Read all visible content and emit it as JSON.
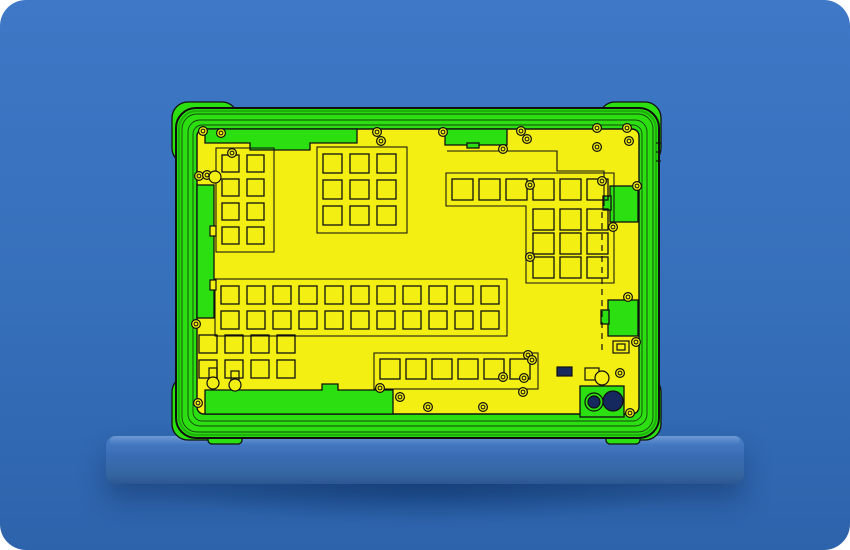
{
  "scene": {
    "alt": "CAD-style cutaway render of a rugged tablet rear shell, shown in bright green and yellow with black outlines, standing on a blue wall shelf against a blue background",
    "palette": {
      "bg_top": "#3e78c6",
      "bg_mid": "#366fba",
      "bg_bottom": "#2d63ab",
      "under_shadow": "#1d4f91",
      "shelf_top": "#4e82ca",
      "shelf_face": "#3a6db6",
      "shelf_edge": "#2b5691",
      "device_green": "#2bdf10",
      "device_green_dark": "#159907",
      "panel_yellow": "#f4ef13",
      "outline": "#101010",
      "lens_navy": "#16295e"
    },
    "device": {
      "grids": [
        {
          "name": "grid-top-left",
          "x": 222,
          "y": 155,
          "cols": 2,
          "rows": 4,
          "cell": 17,
          "px": 25,
          "py": 24
        },
        {
          "name": "grid-top-mid",
          "x": 323,
          "y": 154,
          "cols": 3,
          "rows": 3,
          "cell": 19,
          "px": 27,
          "py": 26
        },
        {
          "name": "row-top-right",
          "x": 452,
          "y": 179,
          "cols": 6,
          "rows": 1,
          "cell": 21,
          "px": 27,
          "py": 27
        },
        {
          "name": "grid-right",
          "x": 533,
          "y": 209,
          "cols": 3,
          "rows": 3,
          "cell": 21,
          "px": 27,
          "py": 24
        },
        {
          "name": "band-middle",
          "x": 221,
          "y": 286,
          "cols": 11,
          "rows": 2,
          "cell": 18,
          "px": 26,
          "py": 25
        },
        {
          "name": "grid-bottom-left",
          "x": 199,
          "y": 335,
          "cols": 4,
          "rows": 2,
          "cell": 18,
          "px": 26,
          "py": 25
        },
        {
          "name": "row-bottom-mid",
          "x": 380,
          "y": 359,
          "cols": 6,
          "rows": 1,
          "cell": 20,
          "px": 26,
          "py": 26
        }
      ],
      "containers": [
        {
          "t": "rect",
          "x": 216,
          "y": 148,
          "w": 58,
          "h": 104
        },
        {
          "t": "rect",
          "x": 317,
          "y": 147,
          "w": 90,
          "h": 86
        },
        {
          "t": "path",
          "d": "M446,173 H614 V283 H526 V206 H446 Z"
        },
        {
          "t": "rect",
          "x": 215,
          "y": 279,
          "w": 292,
          "h": 57
        },
        {
          "t": "rect",
          "x": 374,
          "y": 353,
          "w": 164,
          "h": 36
        }
      ],
      "green_shapes": [
        {
          "t": "rect",
          "x": 197,
          "y": 185,
          "w": 17,
          "h": 133,
          "name": "left-rail"
        },
        {
          "t": "path",
          "d": "M205,129 H357 V143 H310 V150 H250 V143 H205 Z",
          "name": "top-tab-left"
        },
        {
          "t": "rect",
          "x": 445,
          "y": 129,
          "w": 62,
          "h": 16,
          "name": "top-tab-right"
        },
        {
          "t": "rect",
          "x": 467,
          "y": 143,
          "w": 12,
          "h": 5,
          "name": "top-tab-right-notch"
        },
        {
          "t": "path",
          "d": "M205,390 H322 V384 H338 V390 H393 V414 H205 Z",
          "name": "bottom-bracket"
        },
        {
          "t": "rect",
          "x": 610,
          "y": 186,
          "w": 28,
          "h": 36,
          "name": "right-port-upper"
        },
        {
          "t": "rect",
          "x": 603,
          "y": 196,
          "w": 8,
          "h": 14,
          "name": "right-port-upper-step"
        },
        {
          "t": "rect",
          "x": 608,
          "y": 300,
          "w": 30,
          "h": 36,
          "name": "right-port-lower"
        },
        {
          "t": "rect",
          "x": 601,
          "y": 310,
          "w": 8,
          "h": 14,
          "name": "right-port-lower-step"
        },
        {
          "t": "rect",
          "x": 580,
          "y": 386,
          "w": 44,
          "h": 31,
          "name": "camera-module"
        }
      ],
      "details": [
        {
          "t": "rect",
          "x": 557,
          "y": 367,
          "w": 15,
          "h": 9,
          "fill": "navy",
          "name": "connector-chip"
        },
        {
          "t": "rect",
          "x": 613,
          "y": 341,
          "w": 16,
          "h": 12,
          "fill": "none",
          "name": "port-outline"
        },
        {
          "t": "rect",
          "x": 617,
          "y": 344,
          "w": 8,
          "h": 6,
          "fill": "none",
          "name": "port-pin"
        },
        {
          "t": "rect",
          "x": 585,
          "y": 368,
          "w": 14,
          "h": 12,
          "fill": "none",
          "name": "bracket-outline"
        },
        {
          "t": "circle",
          "cx": 594,
          "cy": 402,
          "r": 9,
          "fill": "green",
          "name": "camera-lens-left-ring"
        },
        {
          "t": "circle",
          "cx": 594,
          "cy": 402,
          "r": 6,
          "fill": "navy",
          "name": "camera-lens-left"
        },
        {
          "t": "circle",
          "cx": 613,
          "cy": 401,
          "r": 10,
          "fill": "navy",
          "name": "camera-lens-right"
        },
        {
          "t": "circle",
          "cx": 602,
          "cy": 378,
          "r": 7,
          "fill": "yellow",
          "name": "flash-ring"
        },
        {
          "t": "path",
          "d": "M447,151 H557 V171 H604 V206",
          "fill": "none",
          "name": "trace-line"
        },
        {
          "t": "line",
          "x1": 602,
          "y1": 212,
          "x2": 602,
          "y2": 352,
          "dash": "6 5",
          "name": "fold-line"
        },
        {
          "t": "line",
          "x1": 656,
          "y1": 143,
          "x2": 661,
          "y2": 143,
          "name": "edge-nub"
        },
        {
          "t": "line",
          "x1": 656,
          "y1": 152,
          "x2": 661,
          "y2": 152,
          "name": "edge-nub"
        },
        {
          "t": "line",
          "x1": 656,
          "y1": 161,
          "x2": 661,
          "y2": 161,
          "name": "edge-nub"
        },
        {
          "t": "rect",
          "x": 209,
          "y": 368,
          "w": 8,
          "h": 10,
          "fill": "none",
          "name": "mic-bracket"
        },
        {
          "t": "circle",
          "cx": 213,
          "cy": 383,
          "r": 6,
          "fill": "yellow",
          "name": "mic-hole"
        },
        {
          "t": "rect",
          "x": 231,
          "y": 371,
          "w": 8,
          "h": 10,
          "fill": "none",
          "name": "mic-bracket"
        },
        {
          "t": "circle",
          "cx": 235,
          "cy": 385,
          "r": 6,
          "fill": "yellow",
          "name": "mic-hole"
        },
        {
          "t": "rect",
          "x": 210,
          "y": 226,
          "w": 6,
          "h": 10,
          "fill": "yellow",
          "name": "rail-notch"
        },
        {
          "t": "rect",
          "x": 210,
          "y": 280,
          "w": 6,
          "h": 10,
          "fill": "yellow",
          "name": "rail-notch"
        }
      ],
      "screws": [
        [
          203,
          131
        ],
        [
          221,
          133
        ],
        [
          232,
          153
        ],
        [
          199,
          176
        ],
        [
          207,
          175
        ],
        [
          377,
          132
        ],
        [
          381,
          141
        ],
        [
          443,
          132
        ],
        [
          503,
          149
        ],
        [
          521,
          131
        ],
        [
          527,
          139
        ],
        [
          597,
          128
        ],
        [
          627,
          128
        ],
        [
          597,
          147
        ],
        [
          629,
          141
        ],
        [
          637,
          186
        ],
        [
          530,
          185
        ],
        [
          530,
          257
        ],
        [
          528,
          355
        ],
        [
          628,
          297
        ],
        [
          636,
          342
        ],
        [
          620,
          373
        ],
        [
          630,
          413
        ],
        [
          503,
          377
        ],
        [
          524,
          378
        ],
        [
          532,
          360
        ],
        [
          380,
          388
        ],
        [
          400,
          397
        ],
        [
          428,
          407
        ],
        [
          483,
          407
        ],
        [
          523,
          392
        ],
        [
          196,
          324
        ],
        [
          198,
          403
        ],
        [
          602,
          181
        ],
        [
          613,
          227
        ]
      ],
      "plain_circles": [
        [
          215,
          177,
          6
        ]
      ]
    }
  }
}
